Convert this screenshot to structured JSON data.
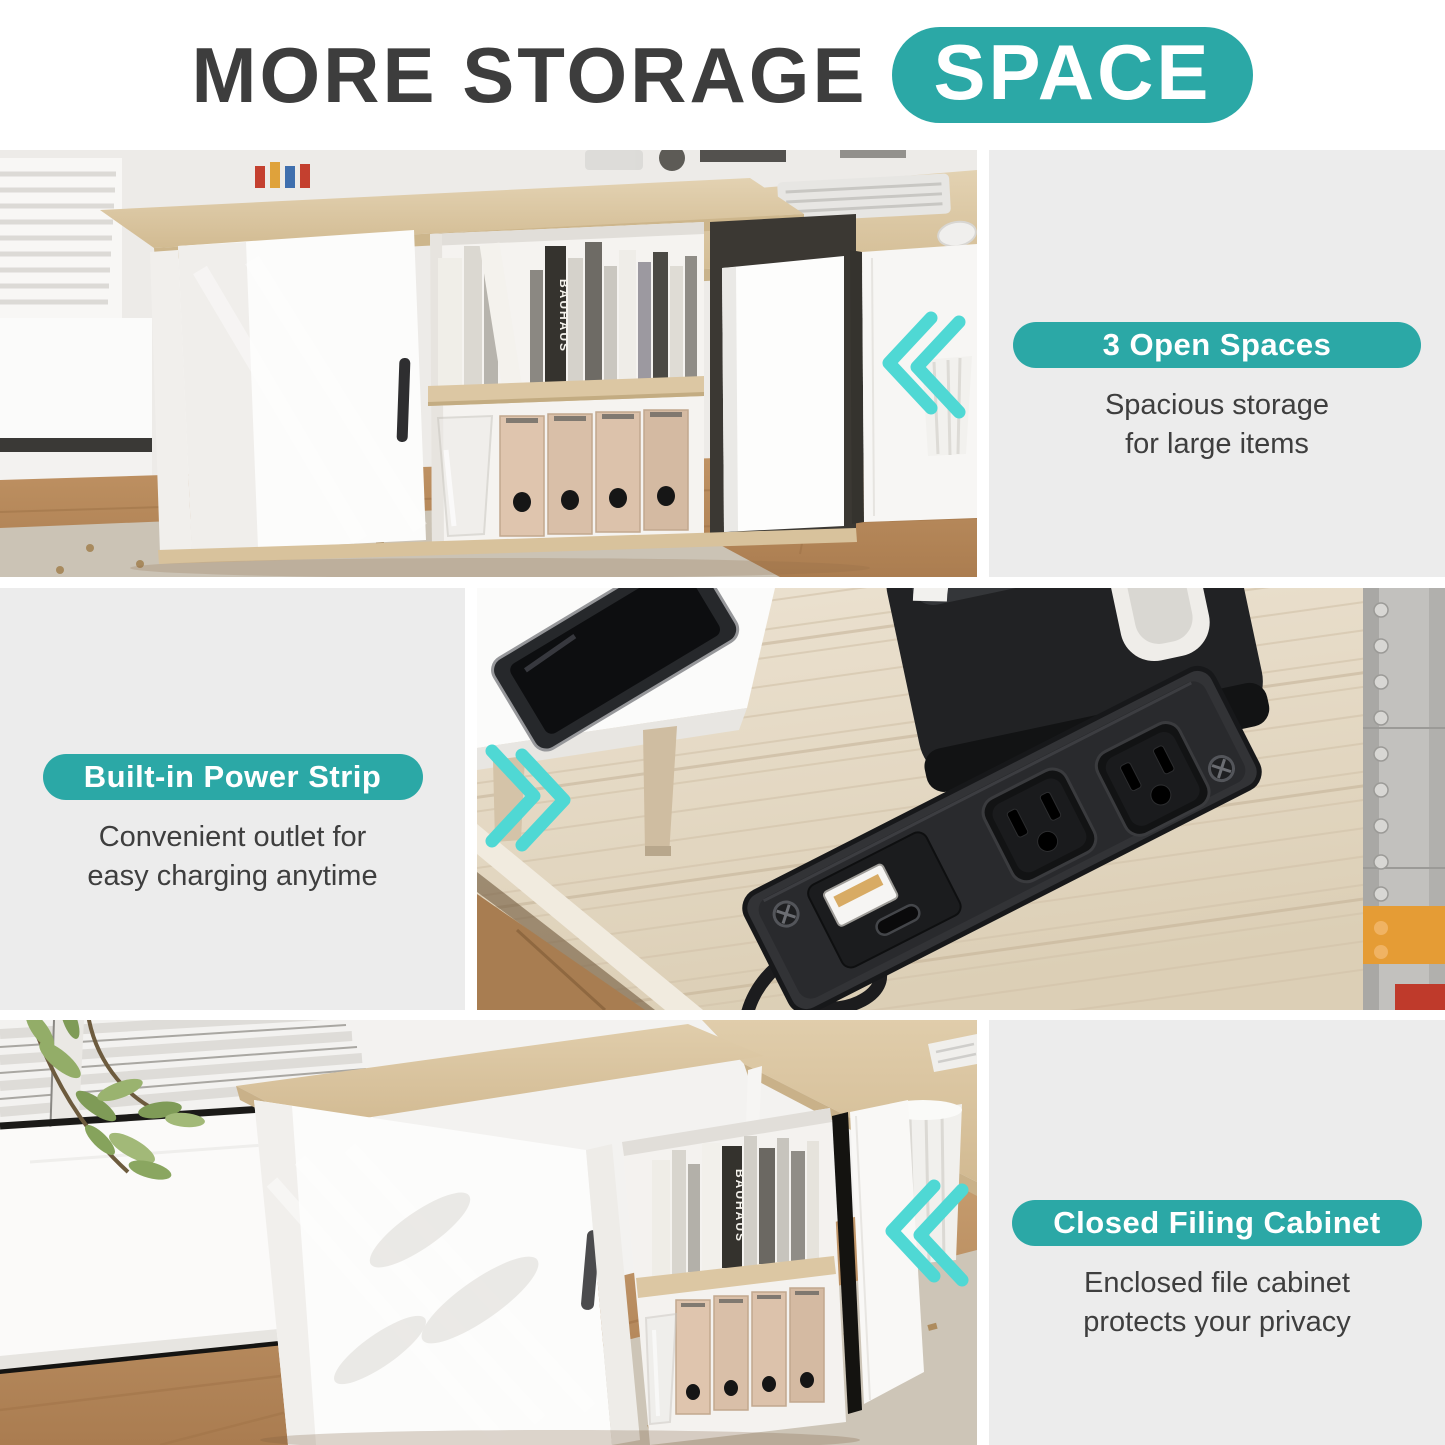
{
  "title": {
    "prefix": "MORE STORAGE",
    "highlight": "SPACE"
  },
  "colors": {
    "accent": "#2ba8a6",
    "chevron": "#4fd8d4",
    "heading": "#3d3d3d",
    "panel_bg": "#ececec",
    "body_text": "#3e3e3e"
  },
  "sections": [
    {
      "id": "open-spaces",
      "badge": "3 Open Spaces",
      "desc_line1": "Spacious storage",
      "desc_line2": "for large items"
    },
    {
      "id": "power-strip",
      "badge": "Built-in Power Strip",
      "desc_line1": "Convenient outlet for",
      "desc_line2": "easy charging anytime"
    },
    {
      "id": "filing-cabinet",
      "badge": "Closed Filing Cabinet",
      "desc_line1": "Enclosed file cabinet",
      "desc_line2": "protects your privacy"
    }
  ],
  "photos": {
    "top": {
      "book_spine_label": "BAUHAUS"
    },
    "bottom": {
      "book_spine_label": "BAUHAUS"
    }
  }
}
